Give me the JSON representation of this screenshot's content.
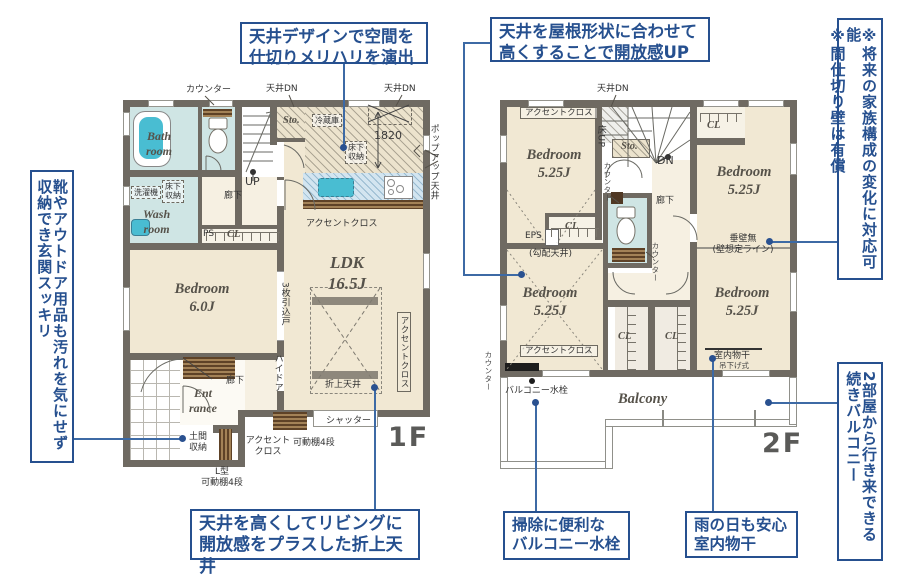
{
  "accent_color": "#26508f",
  "callouts": {
    "ceiling_design": {
      "text": "天井デザインで空間を\n仕切りメリハリを演出"
    },
    "roof_shape": {
      "text": "天井を屋根形状に合わせて\n高くすることで開放感UP"
    },
    "genkan_storage": {
      "text": "靴やアウトドア用品も汚れを気にせず\n収納でき玄関スッキリ"
    },
    "partition_note": {
      "text": "※将来の家族構成の変化に対応可能\n※間仕切り壁は有償"
    },
    "oriage_ceiling": {
      "text": "天井を高くしてリビングに\n開放感をプラスした折上天井"
    },
    "balcony_tap": {
      "text": "掃除に便利な\nバルコニー水栓"
    },
    "indoor_drying": {
      "text": "雨の日も安心\n室内物干"
    },
    "continuous_balcony": {
      "text": "2部屋から行き来できる\n続きバルコニー"
    }
  },
  "labels": [
    {
      "n": "counter-label-1f",
      "t": "カウンター",
      "x": 186,
      "y": 85
    },
    {
      "n": "ceiling-dn-left-label",
      "t": "天井DN",
      "x": 266,
      "y": 84
    },
    {
      "n": "ceiling-dn-right-label",
      "t": "天井DN",
      "x": 384,
      "y": 84
    },
    {
      "n": "storage-label-1f",
      "t": "Sto.",
      "x": 283,
      "y": 114,
      "c": "room room-sm"
    },
    {
      "n": "fridge-label",
      "t": "冷蔵庫",
      "x": 312,
      "y": 114,
      "c": "box"
    },
    {
      "n": "dim-1820-label",
      "t": "1820",
      "x": 374,
      "y": 130,
      "c": "dim"
    },
    {
      "n": "popup-ceiling-label",
      "t": "ポップアップ天井",
      "x": 428,
      "y": 124,
      "c": "v"
    },
    {
      "n": "underfloor-storage-kitchen-label",
      "t": "床下\n収納",
      "x": 345,
      "y": 141,
      "c": "box"
    },
    {
      "n": "accent-cross-kitchen-label",
      "t": "アクセントクロス",
      "x": 306,
      "y": 219
    },
    {
      "n": "ldk-label",
      "t": "LDK\n16.5J",
      "x": 318,
      "y": 252,
      "w": 58,
      "c": "room room-lg"
    },
    {
      "n": "bath-room-label",
      "t": "Bath\nroom",
      "x": 146,
      "y": 129,
      "c": "room"
    },
    {
      "n": "wash-room-label",
      "t": "Wash\nroom",
      "x": 143,
      "y": 207,
      "c": "room"
    },
    {
      "n": "washer-label",
      "t": "洗濯機",
      "x": 131,
      "y": 186,
      "c": "box"
    },
    {
      "n": "underfloor-storage-wash-label",
      "t": "床下\n収納",
      "x": 162,
      "y": 180,
      "c": "box"
    },
    {
      "n": "up-label",
      "t": "UP",
      "x": 245,
      "y": 176,
      "c": "dim"
    },
    {
      "n": "hallway-1f-label",
      "t": "廊下",
      "x": 224,
      "y": 191
    },
    {
      "n": "ps-label",
      "t": "PS",
      "x": 203,
      "y": 229
    },
    {
      "n": "cl-1f-label",
      "t": "CL",
      "x": 227,
      "y": 228,
      "c": "room room-sm"
    },
    {
      "n": "bedroom-1f-label",
      "t": "Bedroom\n6.0J",
      "x": 164,
      "y": 280,
      "w": 76,
      "c": "room room-md"
    },
    {
      "n": "sliding-door-label",
      "t": "3枚引込戸",
      "x": 279,
      "y": 282,
      "c": "v"
    },
    {
      "n": "high-door-label",
      "t": "ハイドア",
      "x": 272,
      "y": 354,
      "c": "v"
    },
    {
      "n": "entrance-label",
      "t": "Ent\nrance",
      "x": 189,
      "y": 386,
      "c": "room"
    },
    {
      "n": "hallway-ent-label",
      "t": "廊下",
      "x": 226,
      "y": 376
    },
    {
      "n": "doma-storage-label",
      "t": "土間\n収納",
      "x": 183,
      "y": 432,
      "w": 30,
      "c": "c"
    },
    {
      "n": "accent-cross-ent-label",
      "t": "アクセント\nクロス",
      "x": 245,
      "y": 436,
      "w": 46,
      "c": "c"
    },
    {
      "n": "shelf4-label",
      "t": "可動棚4段",
      "x": 293,
      "y": 438
    },
    {
      "n": "lshape-shelf-label",
      "t": "L型\n可動棚4段",
      "x": 196,
      "y": 467,
      "w": 52,
      "c": "c"
    },
    {
      "n": "shutter-label",
      "t": "シャッター",
      "x": 326,
      "y": 416
    },
    {
      "n": "oriage-ceiling-label",
      "t": "折上天井",
      "x": 325,
      "y": 380
    },
    {
      "n": "accent-cross-ldk-label",
      "t": "アクセントクロス",
      "x": 397,
      "y": 312,
      "c": "v sbox"
    },
    {
      "n": "floor-label-1f",
      "t": "1F",
      "x": 388,
      "y": 422,
      "c": "big"
    },
    {
      "n": "ceiling-dn-2f-label",
      "t": "天井DN",
      "x": 597,
      "y": 84
    },
    {
      "n": "accent-cross-2f-tl-label",
      "t": "アクセントクロス",
      "x": 520,
      "y": 107,
      "c": "sbox2"
    },
    {
      "n": "bedroom-2f-tl-label",
      "t": "Bedroom\n5.25J",
      "x": 516,
      "y": 146,
      "w": 76,
      "c": "room room-md"
    },
    {
      "n": "floor-up-label",
      "t": "床UP",
      "x": 595,
      "y": 125,
      "c": "v"
    },
    {
      "n": "storage-2f-label",
      "t": "Sto.",
      "x": 621,
      "y": 140,
      "c": "room room-sm"
    },
    {
      "n": "dn-label",
      "t": "DN",
      "x": 657,
      "y": 155,
      "c": "dim"
    },
    {
      "n": "counter-2f-stairs-label",
      "t": "カウンター",
      "x": 602,
      "y": 162,
      "c": "v tiny"
    },
    {
      "n": "hallway-2f-label",
      "t": "廊下",
      "x": 656,
      "y": 196
    },
    {
      "n": "cl-2f-tr-label",
      "t": "CL",
      "x": 707,
      "y": 119,
      "c": "room room-sm"
    },
    {
      "n": "bedroom-2f-tr-label",
      "t": "Bedroom\n5.25J",
      "x": 706,
      "y": 163,
      "w": 76,
      "c": "room room-md"
    },
    {
      "n": "eps-label",
      "t": "EPS",
      "x": 525,
      "y": 231
    },
    {
      "n": "slope-ceiling-label",
      "t": "(勾配天井)",
      "x": 529,
      "y": 249
    },
    {
      "n": "cl-2f-ml-label",
      "t": "CL",
      "x": 565,
      "y": 220,
      "c": "room room-sm"
    },
    {
      "n": "tarekabe-label",
      "t": "垂壁無\n(壁想定ライン)",
      "x": 702,
      "y": 234,
      "w": 82,
      "c": "c"
    },
    {
      "n": "counter-2f-toilet-label",
      "t": "カウンター",
      "x": 650,
      "y": 242,
      "c": "v tiny"
    },
    {
      "n": "bedroom-2f-bl-label",
      "t": "Bedroom\n5.25J",
      "x": 512,
      "y": 284,
      "w": 76,
      "c": "room room-md"
    },
    {
      "n": "accent-cross-2f-bl-label",
      "t": "アクセントクロス",
      "x": 520,
      "y": 345,
      "c": "sbox2"
    },
    {
      "n": "counter-balcony-label",
      "t": "カウンター",
      "x": 483,
      "y": 351,
      "c": "v tiny"
    },
    {
      "n": "balcony-tap-label",
      "t": "バルコニー水栓",
      "x": 505,
      "y": 386
    },
    {
      "n": "cl-2f-mb1-label",
      "t": "CL",
      "x": 618,
      "y": 330,
      "c": "room room-sm"
    },
    {
      "n": "cl-2f-mb2-label",
      "t": "CL",
      "x": 665,
      "y": 330,
      "c": "room room-sm"
    },
    {
      "n": "bedroom-2f-br-label",
      "t": "Bedroom\n5.25J",
      "x": 704,
      "y": 284,
      "w": 76,
      "c": "room room-md"
    },
    {
      "n": "monohoshi-label",
      "t": "室内物干",
      "x": 714,
      "y": 351
    },
    {
      "n": "monohoshi-sub-label",
      "t": "吊下げ式",
      "x": 719,
      "y": 362,
      "c": "tiny"
    },
    {
      "n": "balcony-label",
      "t": "Balcony",
      "x": 618,
      "y": 390,
      "c": "room room-md"
    },
    {
      "n": "floor-label-2f",
      "t": "2F",
      "x": 762,
      "y": 428,
      "c": "big"
    }
  ]
}
